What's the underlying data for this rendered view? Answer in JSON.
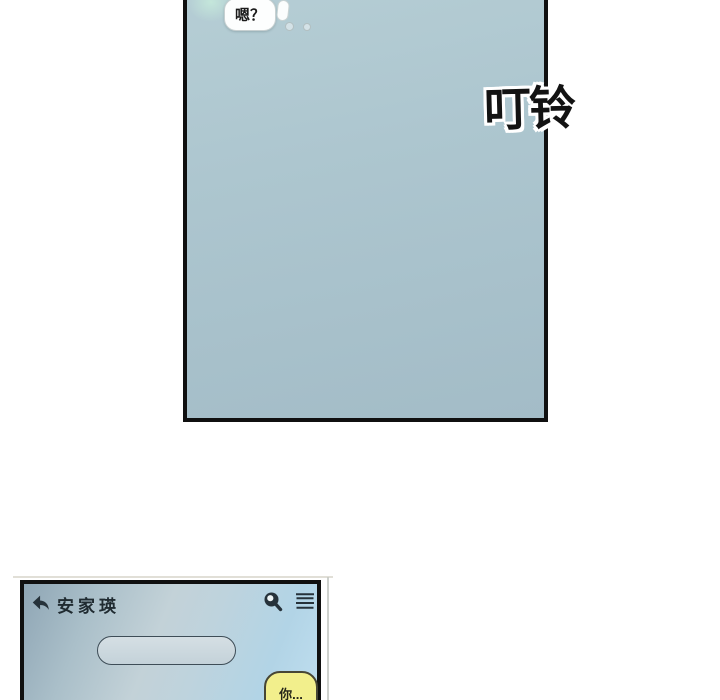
{
  "sfx": {
    "text": "叮铃"
  },
  "top_panel": {
    "speech_bubble_text": "嗯？"
  },
  "chat_panel": {
    "header": {
      "contact_name": "安家瑛",
      "back_icon": "back-arrow",
      "search_icon": "magnifier",
      "menu_icon": "hamburger-menu"
    },
    "message_bubble": {
      "text": "你...",
      "fill": "#f2ef8c"
    }
  },
  "colors": {
    "panel_border": "#101010",
    "top_panel_blue": "#a9c3cd",
    "mint_glow": "#c5e8db",
    "chat_gradient_dark": "#8fa6b5",
    "chat_gradient_light": "#bfdeef",
    "capsule_fill": "#ccd8de",
    "bubble_yellow": "#f2ef8c",
    "icon_ink": "#26323a",
    "sfx_ink": "#131313"
  }
}
